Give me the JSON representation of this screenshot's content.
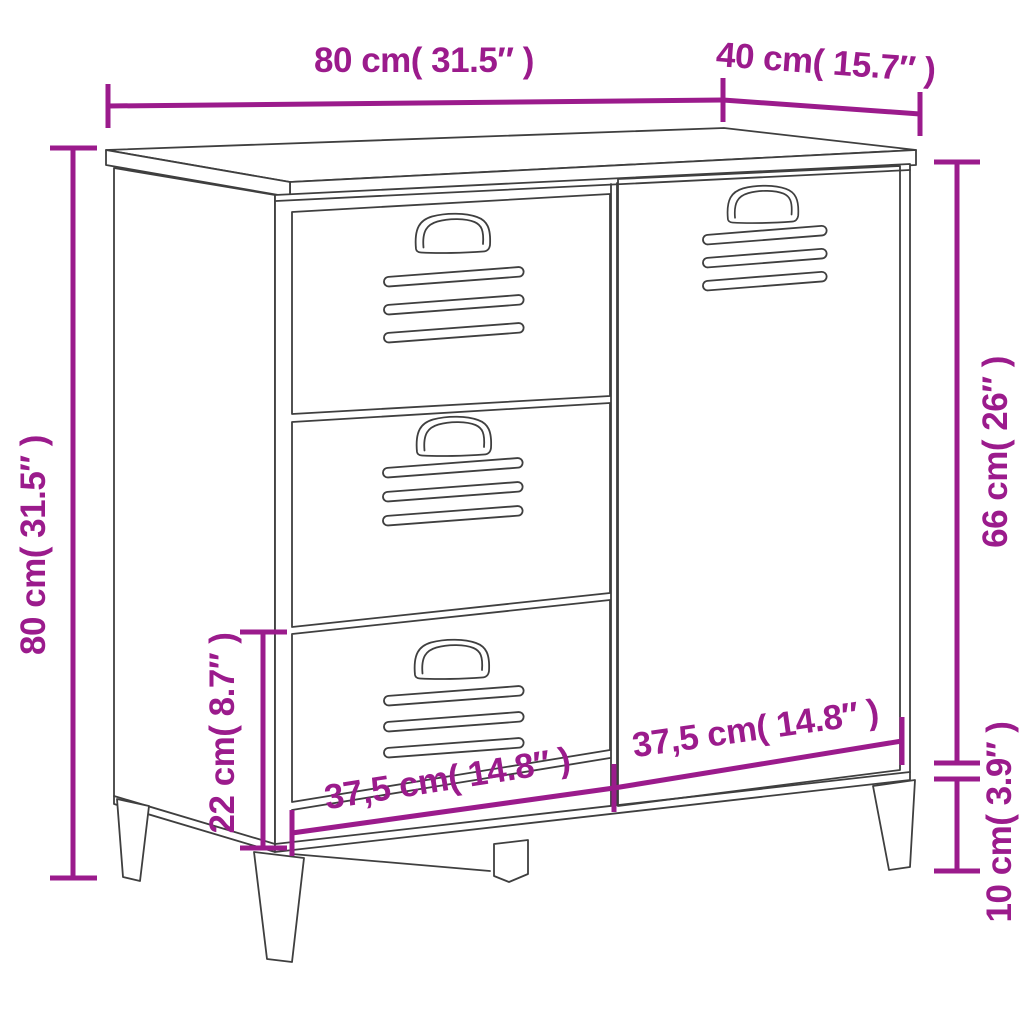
{
  "diagram": {
    "colors": {
      "dimension_accent": "#9B1B8C",
      "line_art": "#3F3F3F",
      "background": "#FFFFFF"
    },
    "dimensions": {
      "top_width_label": "80 cm( 31.5″ )",
      "top_depth_label": "40 cm( 15.7″ )",
      "overall_height_label": "80 cm( 31.5″ )",
      "door_height_label": "66 cm( 26″ )",
      "drawer_section_height_label": "22 cm( 8.7″ )",
      "leg_height_label": "10 cm( 3.9″ )",
      "bottom_left_width_label": "37,5 cm( 14.8″ )",
      "bottom_right_width_label": "37,5 cm( 14.8″ )"
    }
  }
}
